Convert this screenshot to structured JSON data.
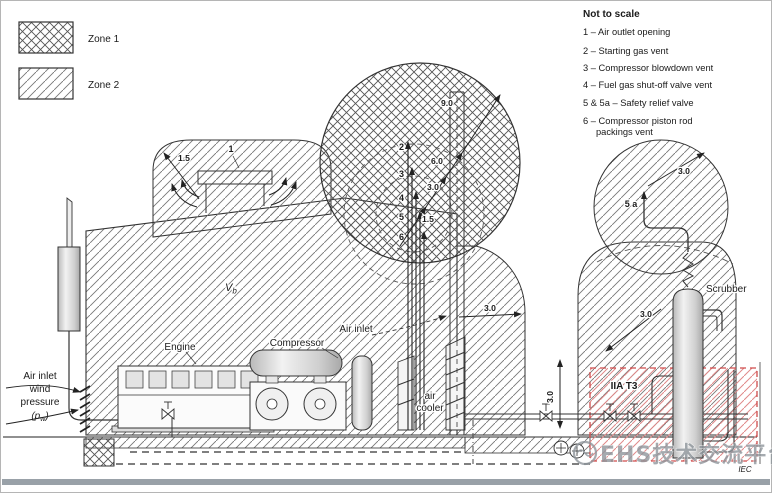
{
  "legend": {
    "zone1_label": "Zone 1",
    "zone2_label": "Zone 2"
  },
  "notes": {
    "title": "Not to scale",
    "item1": "1 – Air outlet opening",
    "item2": "2 – Starting gas vent",
    "item3": "3 – Compressor blowdown vent",
    "item4": "4 – Fuel gas shut-off valve vent",
    "item5": "5 & 5a – Safety relief valve",
    "item6a": "6 – Compressor piston rod",
    "item6b": "packings vent"
  },
  "equipment": {
    "engine": "Engine",
    "compressor": "Compressor",
    "air_inlet": "Air inlet",
    "air_cooler_1": "air",
    "air_cooler_2": "cooler",
    "scrubber": "Scrubber"
  },
  "vent_numbers": {
    "n1": "1",
    "n2": "2",
    "n3": "3",
    "n4": "4",
    "n5": "5",
    "n6": "6",
    "n5a": "5 a"
  },
  "dimensions": {
    "roof_zone_radius": "1.5",
    "vent_r1": "1.5",
    "vent_r2": "3.0",
    "vent_r3": "6.0",
    "vent_r4": "9.0",
    "east_zone_radius": "3.0",
    "stack_height": "3.0",
    "scrubber_vent_radius": "3.0",
    "scrubber_zone_radius": "3.0"
  },
  "annotations": {
    "building_volume_v": "V",
    "building_volume_sub": "b",
    "gas_group": "IIA T3",
    "wind_1": "Air inlet",
    "wind_2": "wind",
    "wind_3": "pressure",
    "wind_p_open": "(p",
    "wind_p_sub": "w",
    "wind_p_close": ")",
    "iec_mark": "IEC"
  },
  "watermark": {
    "text": "EHS技术交流平台"
  },
  "colors": {
    "line": "#333333",
    "zone_hatch": "#6e6e6e",
    "red_box": "#cf4a4a",
    "red_hatch": "#e08989",
    "watermark": "#8f969c",
    "bottom_bar": "#99a1a8"
  }
}
